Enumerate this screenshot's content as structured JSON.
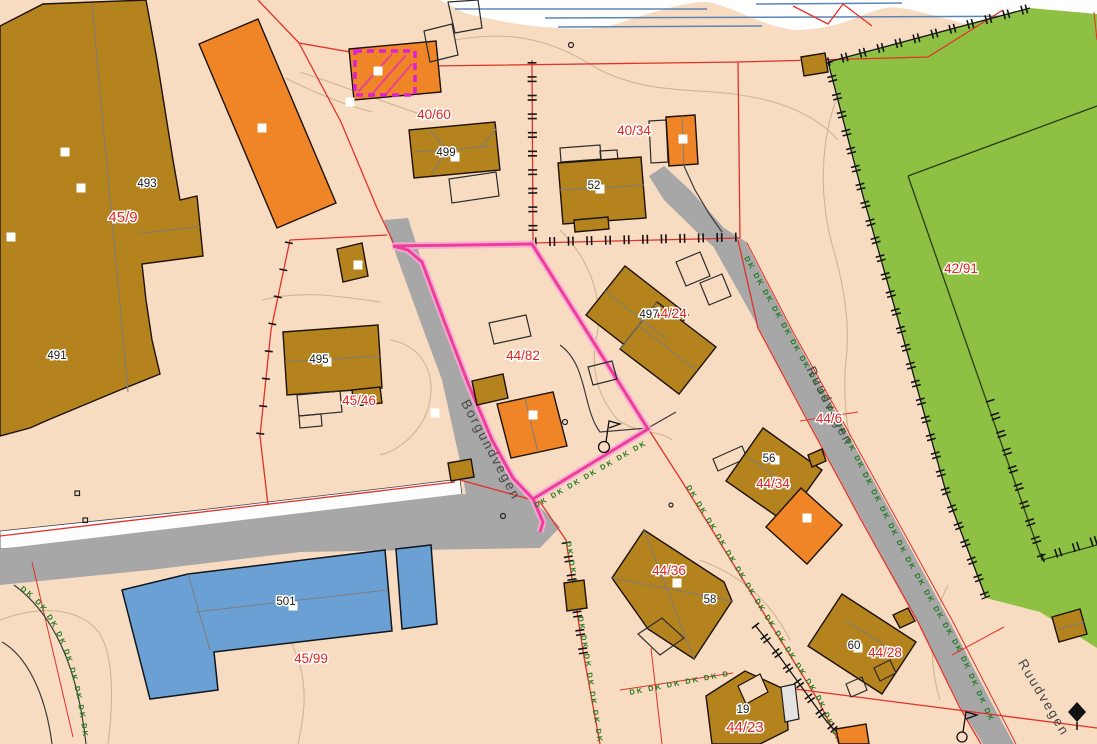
{
  "map_view": {
    "title": "Cadastral map view",
    "streets": {
      "borgundvegen": "Borgundvegen",
      "ruudvegen_upper": "Ruudvegen",
      "ruudvegen_lower": "Ruudvegen"
    },
    "parcels": {
      "p45_9": "45/9",
      "p40_60": "40/60",
      "p40_34": "40/34",
      "p42_91": "42/91",
      "p44_82": "44/82",
      "p44_24": "44/24",
      "p44_6": "44/6",
      "p45_46": "45/46",
      "p44_34": "44/34",
      "p44_36": "44/36",
      "p45_99": "45/99",
      "p44_28": "44/28",
      "p44_23": "44/23"
    },
    "buildings": {
      "b493": "493",
      "b491": "491",
      "b499": "499",
      "b52": "52",
      "b495": "495",
      "b497": "497",
      "b56": "56",
      "b58": "58",
      "b501": "501",
      "b60": "60",
      "b19": "19"
    },
    "annotations": {
      "ditch_marker_chain": "DK DK DK DK DK DK DK DK DK DK DK DK DK DK DK DK DK DK DK DK DK DK DK DK DK DK DK DK"
    },
    "colors": {
      "background_beige": "#f8dcc2",
      "building_brown": "#b5831d",
      "building_orange": "#ef8526",
      "building_blue": "#6aa0d4",
      "field_green": "#8ec043",
      "road_gray": "#a7a7a7",
      "boundary_red": "#e2312a",
      "parcel_label_red": "#e3231c",
      "highlight_pink": "#ef3d9c",
      "selection_magenta": "#df1fd3",
      "water_line_blue": "#5b85b8",
      "contour_tan": "#cdb593",
      "ditch_marker_green": "#1f7a1f"
    }
  }
}
